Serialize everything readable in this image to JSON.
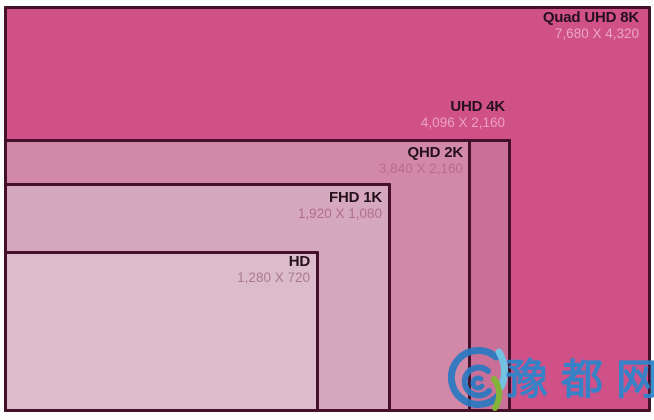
{
  "diagram": {
    "description": "Nested rectangles comparing display resolutions",
    "resolutions": [
      {
        "id": "quad-uhd-8k",
        "label": "Quad UHD 8K",
        "dimensions": "7,680 X 4,320",
        "fill": "#cf5188",
        "subtitle_color": "#eba6c2"
      },
      {
        "id": "uhd-4k",
        "label": "UHD 4K",
        "dimensions": "4,096 X 2,160",
        "fill": "#ca7098",
        "subtitle_color": "#eca1c1"
      },
      {
        "id": "qhd-2k",
        "label": "QHD 2K",
        "dimensions": "3,840 X 2,160",
        "fill": "#d189a7",
        "subtitle_color": "#bb6a8e"
      },
      {
        "id": "fhd-1k",
        "label": "FHD 1K",
        "dimensions": "1,920 X 1,080",
        "fill": "#d5a8bd",
        "subtitle_color": "#af6d8c"
      },
      {
        "id": "hd",
        "label": "HD",
        "dimensions": "1,280 X 720",
        "fill": "#dcbcca",
        "subtitle_color": "#aa7a91"
      }
    ]
  },
  "watermark": {
    "text": "豫都网",
    "color": "#2b86cc",
    "logo": "spiral-swirl-logo",
    "logo_colors": {
      "spiral": "#2a79c2",
      "leaf": "#6cc9e8",
      "swoosh": "#7db930"
    }
  },
  "colors": {
    "border": "#45112a",
    "title_text": "#26101c",
    "background": "#ffffff"
  }
}
